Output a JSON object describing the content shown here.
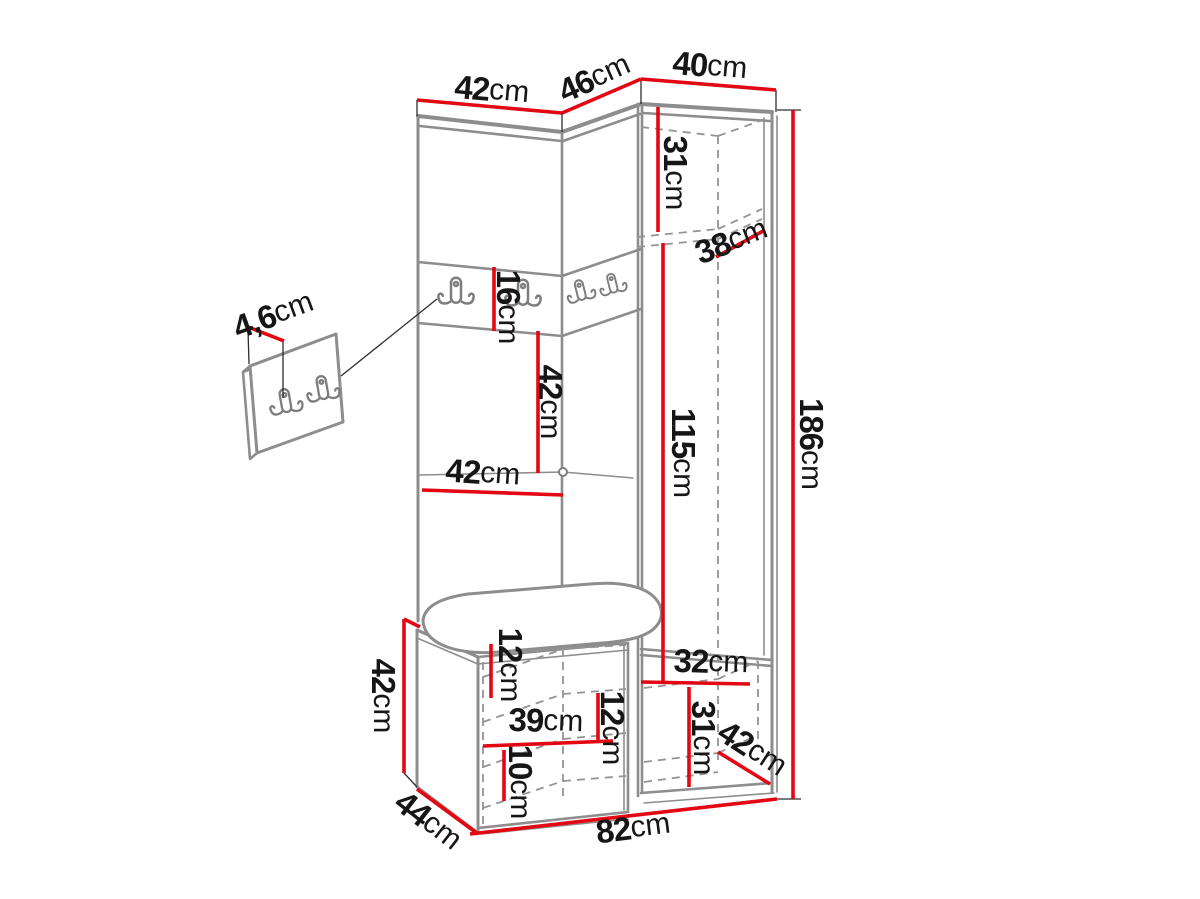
{
  "diagram": {
    "description": "Technical dimension drawing of a corner hallway wardrobe set with coat hook rail, bench seat and tall cabinet, plus a detail view of the wall hook plate",
    "unit": "cm",
    "colors": {
      "dimension_line": "#e30613",
      "outline": "#8d8d8d",
      "label_text": "#161616",
      "background": "#ffffff"
    },
    "dims": {
      "top_left_width": {
        "num": "42",
        "unit": "cm"
      },
      "top_middle_width": {
        "num": "46",
        "unit": "cm"
      },
      "top_right_width": {
        "num": "40",
        "unit": "cm"
      },
      "total_height": {
        "num": "186",
        "unit": "cm"
      },
      "upper_compartment_height": {
        "num": "31",
        "unit": "cm"
      },
      "top_depth": {
        "num": "38",
        "unit": "cm"
      },
      "hook_rail_height": {
        "num": "16",
        "unit": "cm"
      },
      "niche_height": {
        "num": "42",
        "unit": "cm"
      },
      "niche_width": {
        "num": "42",
        "unit": "cm"
      },
      "door_section_height": {
        "num": "115",
        "unit": "cm"
      },
      "hook_plate_thickness": {
        "num": "4,6",
        "unit": "cm"
      },
      "bench_height": {
        "num": "42",
        "unit": "cm"
      },
      "bench_top_clearance": {
        "num": "12",
        "unit": "cm"
      },
      "bench_shelf_width": {
        "num": "39",
        "unit": "cm"
      },
      "bench_middle_clearance": {
        "num": "12",
        "unit": "cm"
      },
      "bench_bottom_clearance": {
        "num": "10",
        "unit": "cm"
      },
      "lower_compartment_width": {
        "num": "32",
        "unit": "cm"
      },
      "lower_compartment_height": {
        "num": "31",
        "unit": "cm"
      },
      "bottom_depth": {
        "num": "42",
        "unit": "cm"
      },
      "total_width": {
        "num": "82",
        "unit": "cm"
      },
      "bench_depth": {
        "num": "44",
        "unit": "cm"
      }
    }
  }
}
